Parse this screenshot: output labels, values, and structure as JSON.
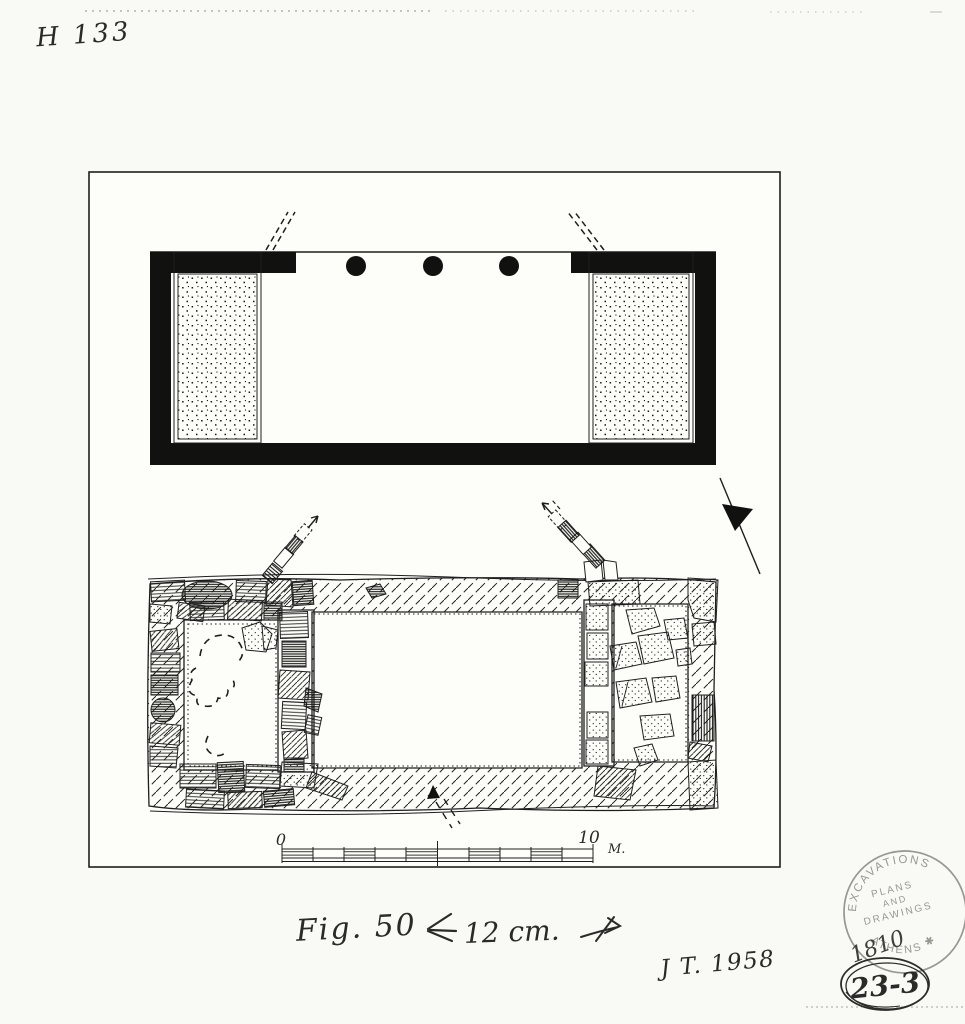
{
  "page": {
    "background": "#f9f9f6",
    "paper": "#fdfdfa",
    "ink_color": "#1e1e1e",
    "stamp_color": "#8e8e86"
  },
  "annotations": {
    "catalog_number": "H 133",
    "figure_label": "Fig. 50",
    "size_note": "12 cm.",
    "initials_date": "J T. 1958"
  },
  "scale_bar": {
    "start_label": "0",
    "end_label": "10",
    "unit": "M."
  },
  "stamp": {
    "rim_top": "EXCAVATIONS",
    "rim_bottom": "ATHENS ✱",
    "line1": "PLANS",
    "line2": "AND",
    "line3": "DRAWINGS",
    "number": "1810"
  },
  "tag": {
    "number": "23-3"
  }
}
